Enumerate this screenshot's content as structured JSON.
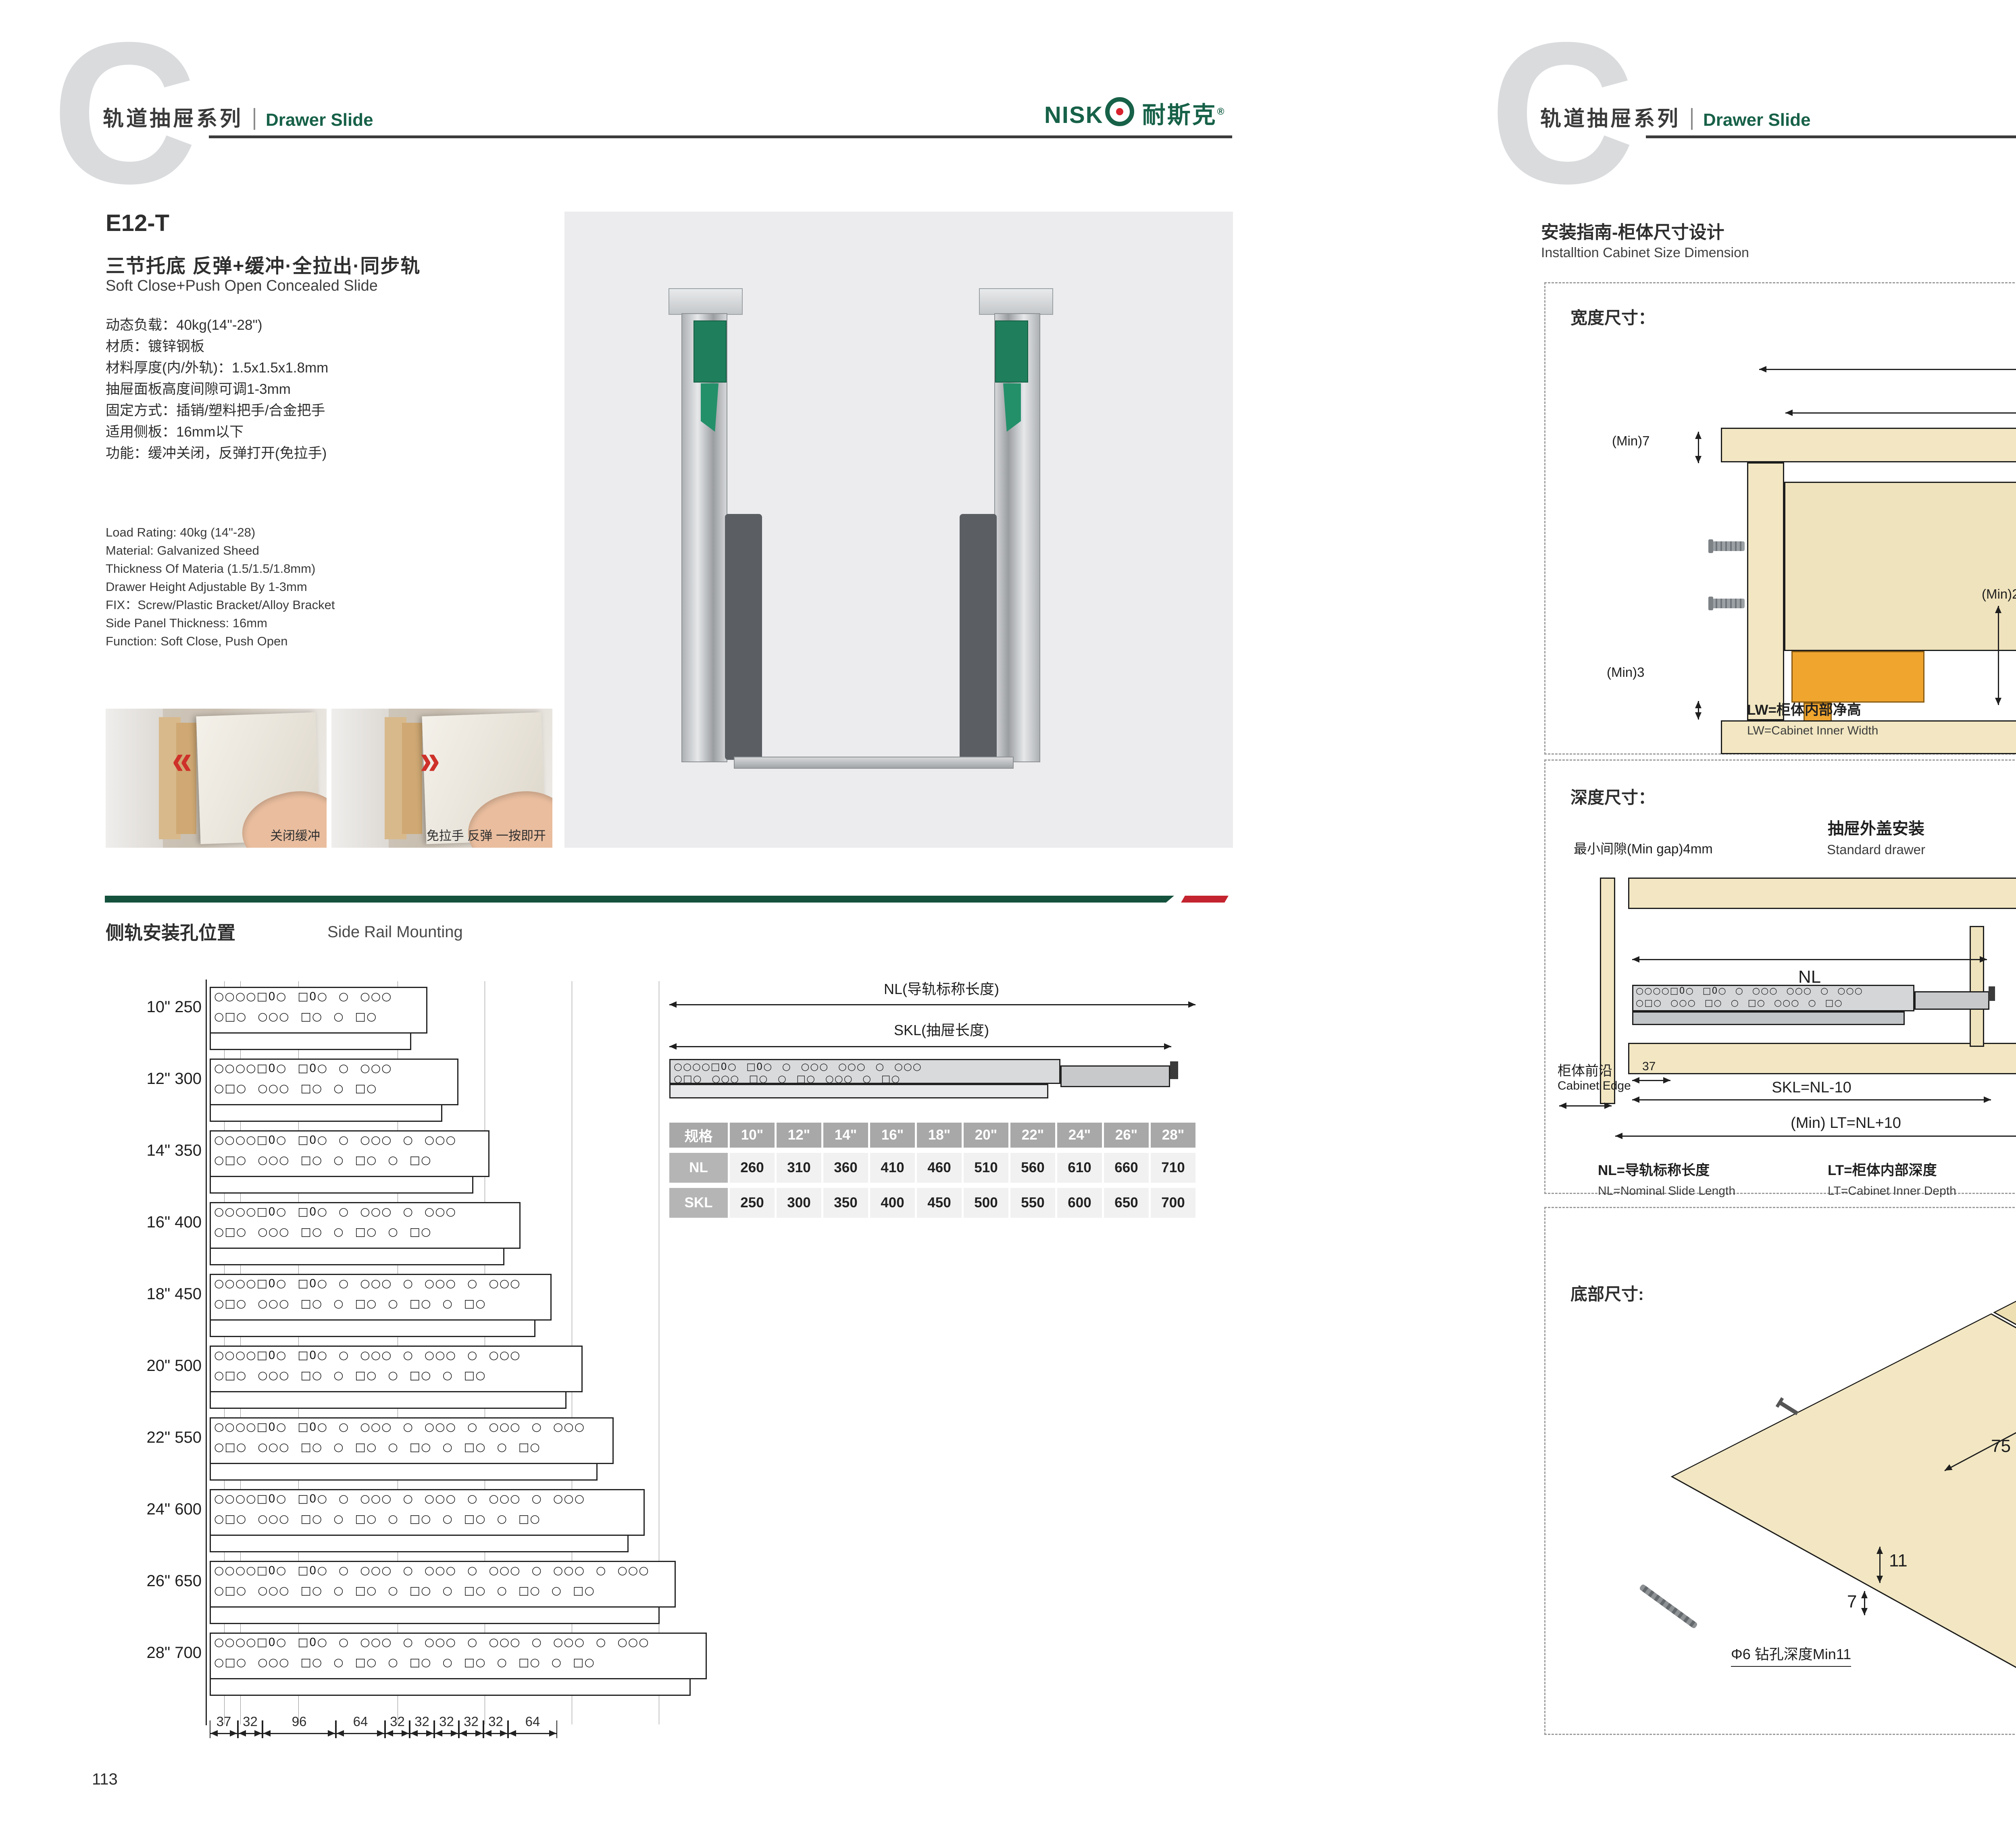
{
  "brand": {
    "name": "NISK",
    "cn": "耐斯克",
    "reg": "®"
  },
  "header": {
    "series_cn": "轨道抽屉系列",
    "series_en": "Drawer Slide"
  },
  "left": {
    "page_no": "113",
    "model": "E12-T",
    "title_cn": "三节托底 反弹+缓冲·全拉出·同步轨",
    "title_en": "Soft Close+Push Open Concealed Slide",
    "specs_cn": [
      "动态负载：40kg(14\"-28\")",
      "材质：镀锌钢板",
      "材料厚度(内/外轨)：1.5x1.5x1.8mm",
      "抽屉面板高度间隙可调1-3mm",
      "固定方式：插销/塑料把手/合金把手",
      "适用侧板：16mm以下",
      "功能：缓冲关闭，反弹打开(免拉手)"
    ],
    "specs_en": [
      "Load Rating: 40kg (14\"-28)",
      "Material: Galvanized Sheed",
      "Thickness Of Materia (1.5/1.5/1.8mm)",
      "Drawer Height Adjustable By 1-3mm",
      "FIX：Screw/Plastic Bracket/Alloy Bracket",
      "Side Panel Thickness: 16mm",
      "Function: Soft Close, Push Open"
    ],
    "photos": [
      {
        "caption": "关闭缓冲"
      },
      {
        "caption": "免拉手 反弹 一按即开"
      }
    ],
    "section_title_cn": "侧轨安装孔位置",
    "section_title_en": "Side Rail Mounting",
    "rail": {
      "rows": [
        {
          "label": "10\" 250"
        },
        {
          "label": "12\" 300"
        },
        {
          "label": "14\" 350"
        },
        {
          "label": "16\" 400"
        },
        {
          "label": "18\" 450"
        },
        {
          "label": "20\" 500"
        },
        {
          "label": "22\" 550"
        },
        {
          "label": "24\" 600"
        },
        {
          "label": "26\" 650"
        },
        {
          "label": "28\" 700"
        }
      ],
      "top_dims": [
        "9 9 9",
        "32",
        "9 9",
        "14 9 9",
        "14 9 9",
        "14 9 9",
        "9 9"
      ],
      "bottom_dims": [
        "37",
        "32",
        "96",
        "64",
        "32",
        "32",
        "32",
        "32",
        "32",
        "64"
      ],
      "nl_label": "NL(导轨标称长度)",
      "skl_label": "SKL(抽屉长度)"
    },
    "table": {
      "spec_header": "规格",
      "sizes": [
        "10\"",
        "12\"",
        "14\"",
        "16\"",
        "18\"",
        "20\"",
        "22\"",
        "24\"",
        "26\"",
        "28\""
      ],
      "rows": [
        {
          "label": "NL",
          "values": [
            "260",
            "310",
            "360",
            "410",
            "460",
            "510",
            "560",
            "610",
            "660",
            "710"
          ]
        },
        {
          "label": "SKL",
          "values": [
            "250",
            "300",
            "350",
            "400",
            "450",
            "500",
            "550",
            "600",
            "650",
            "700"
          ]
        }
      ]
    }
  },
  "right": {
    "page_no": "114",
    "title_cn": "安装指南-柜体尺寸设计",
    "title_en": "Installtion Cabinet Size Dimension",
    "width": {
      "title": "宽度尺寸：",
      "lw": "LW",
      "skw": "SKW=LW-42",
      "min7": "(Min)7",
      "max16": "(Max)16",
      "d12": "12",
      "d10": "10",
      "d37": "37",
      "min275": "(Min)27.5",
      "min3": "(Min)3",
      "d21": "21",
      "legend": [
        {
          "cn": "LW=柜体内部净高",
          "en": "LW=Cabinet Inner Width"
        },
        {
          "cn": "SKW=抽屉宽度",
          "en": "SKW=Drawer  Width"
        },
        {
          "cn": "最大尺寸",
          "en": "Max"
        },
        {
          "cn": "最小尺寸",
          "en": "Min"
        }
      ]
    },
    "depth": {
      "title": "深度尺寸：",
      "min_gap": "最小间隙(Min gap)4mm",
      "std_cn": "抽屉外盖安装",
      "std_en": "Standard drawer",
      "bi_cn": "抽屉内置安装",
      "bi_en": "Built-in drawer",
      "edge_cn": "柜体前沿",
      "edge_en": "Cabinet Edge",
      "nl": "NL",
      "x": "X",
      "d37": "37",
      "skl": "SKL=NL-10",
      "lt_std": "(Min) LT=NL+10",
      "iskl": "ISKL=SKL+X",
      "lt_bi": "(Min) LT=NL+X+10",
      "legend": [
        {
          "cn": "NL=导轨标称长度",
          "en": "NL=Nominal Slide Length"
        },
        {
          "cn": "LT=柜体内部深度",
          "en": "LT=Cabinet Inner Depth"
        },
        {
          "cn": "SKL=抽屉长度",
          "en": "SKL=Drawer Length"
        },
        {
          "cn": "ISKL=内抽屉长度",
          "en": "ISKL=Drawer Inner Length"
        },
        {
          "cn": "X=抽屉面板厚度",
          "en": "X=Drawer Panel Thickness"
        }
      ]
    },
    "bottom": {
      "title": "底部尺寸:",
      "d75": "75",
      "d85": "85",
      "d11": "11",
      "d7": "7",
      "drill": "Φ6 钻孔深度Min11",
      "diagonal": "抽屉长度SKL=导轨标称长度NL-10"
    }
  },
  "colors": {
    "green": "#176149",
    "divider_green": "#14523e",
    "red": "#c4242f",
    "wood": "#f2e7c2",
    "orange": "#f0a52f"
  }
}
